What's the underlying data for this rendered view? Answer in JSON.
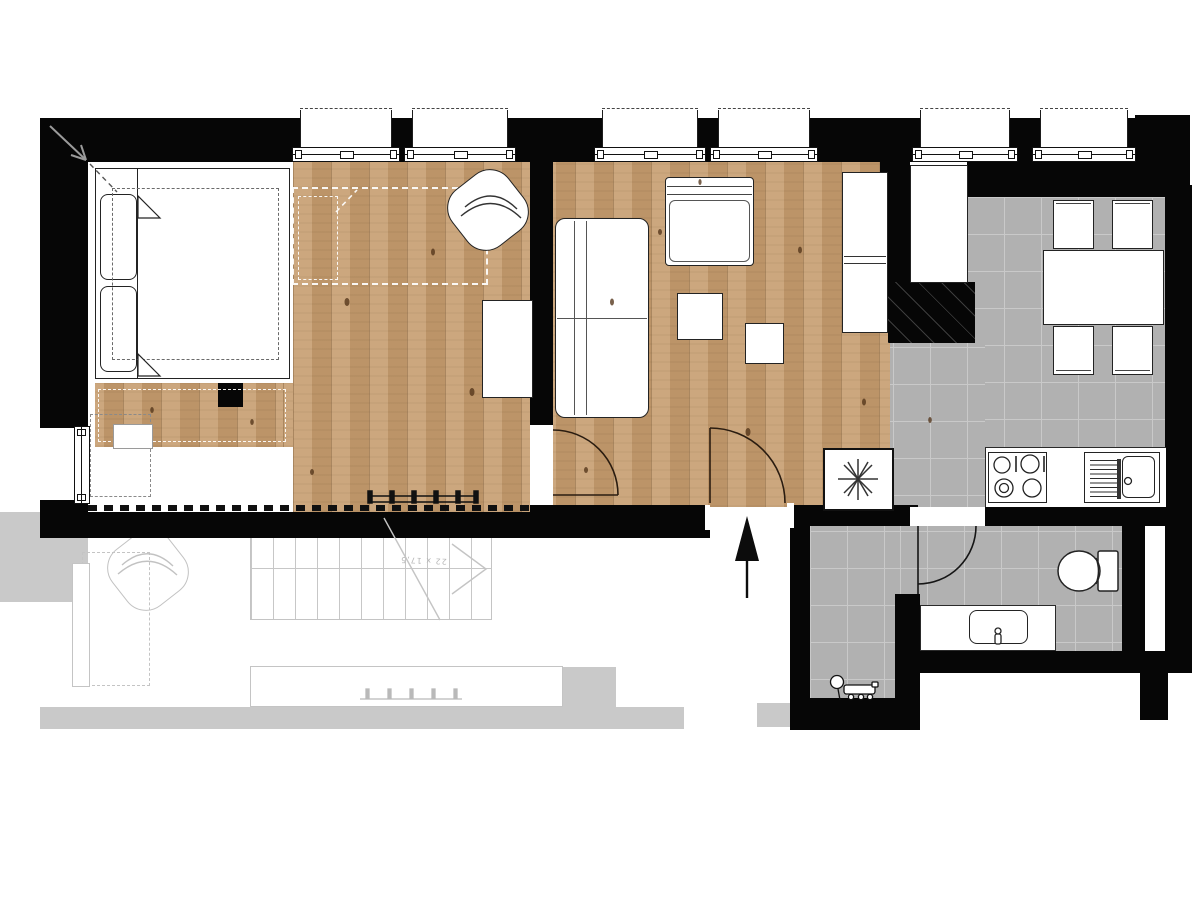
{
  "document": {
    "kind": "apartment floor plan drawing",
    "visible_text": [
      "22 x 17,5"
    ]
  },
  "stairs": {
    "annotation": "22 x 17,5"
  },
  "colors": {
    "wall": "#060606",
    "wood_floor": "#c69d6f",
    "tile_floor": "#b1b1b1",
    "ghost_level": "#c9c9c9",
    "paper": "#ffffff",
    "furniture_outline": "#232323"
  },
  "counts": {
    "windows_top": 6,
    "dining_chairs": 4,
    "door_swings": 3
  },
  "icons": {
    "shower_symbol": "asterisk-icon",
    "entry_direction": "arrow-up-icon",
    "slope_marker": "diagonal-arrow-icon"
  }
}
